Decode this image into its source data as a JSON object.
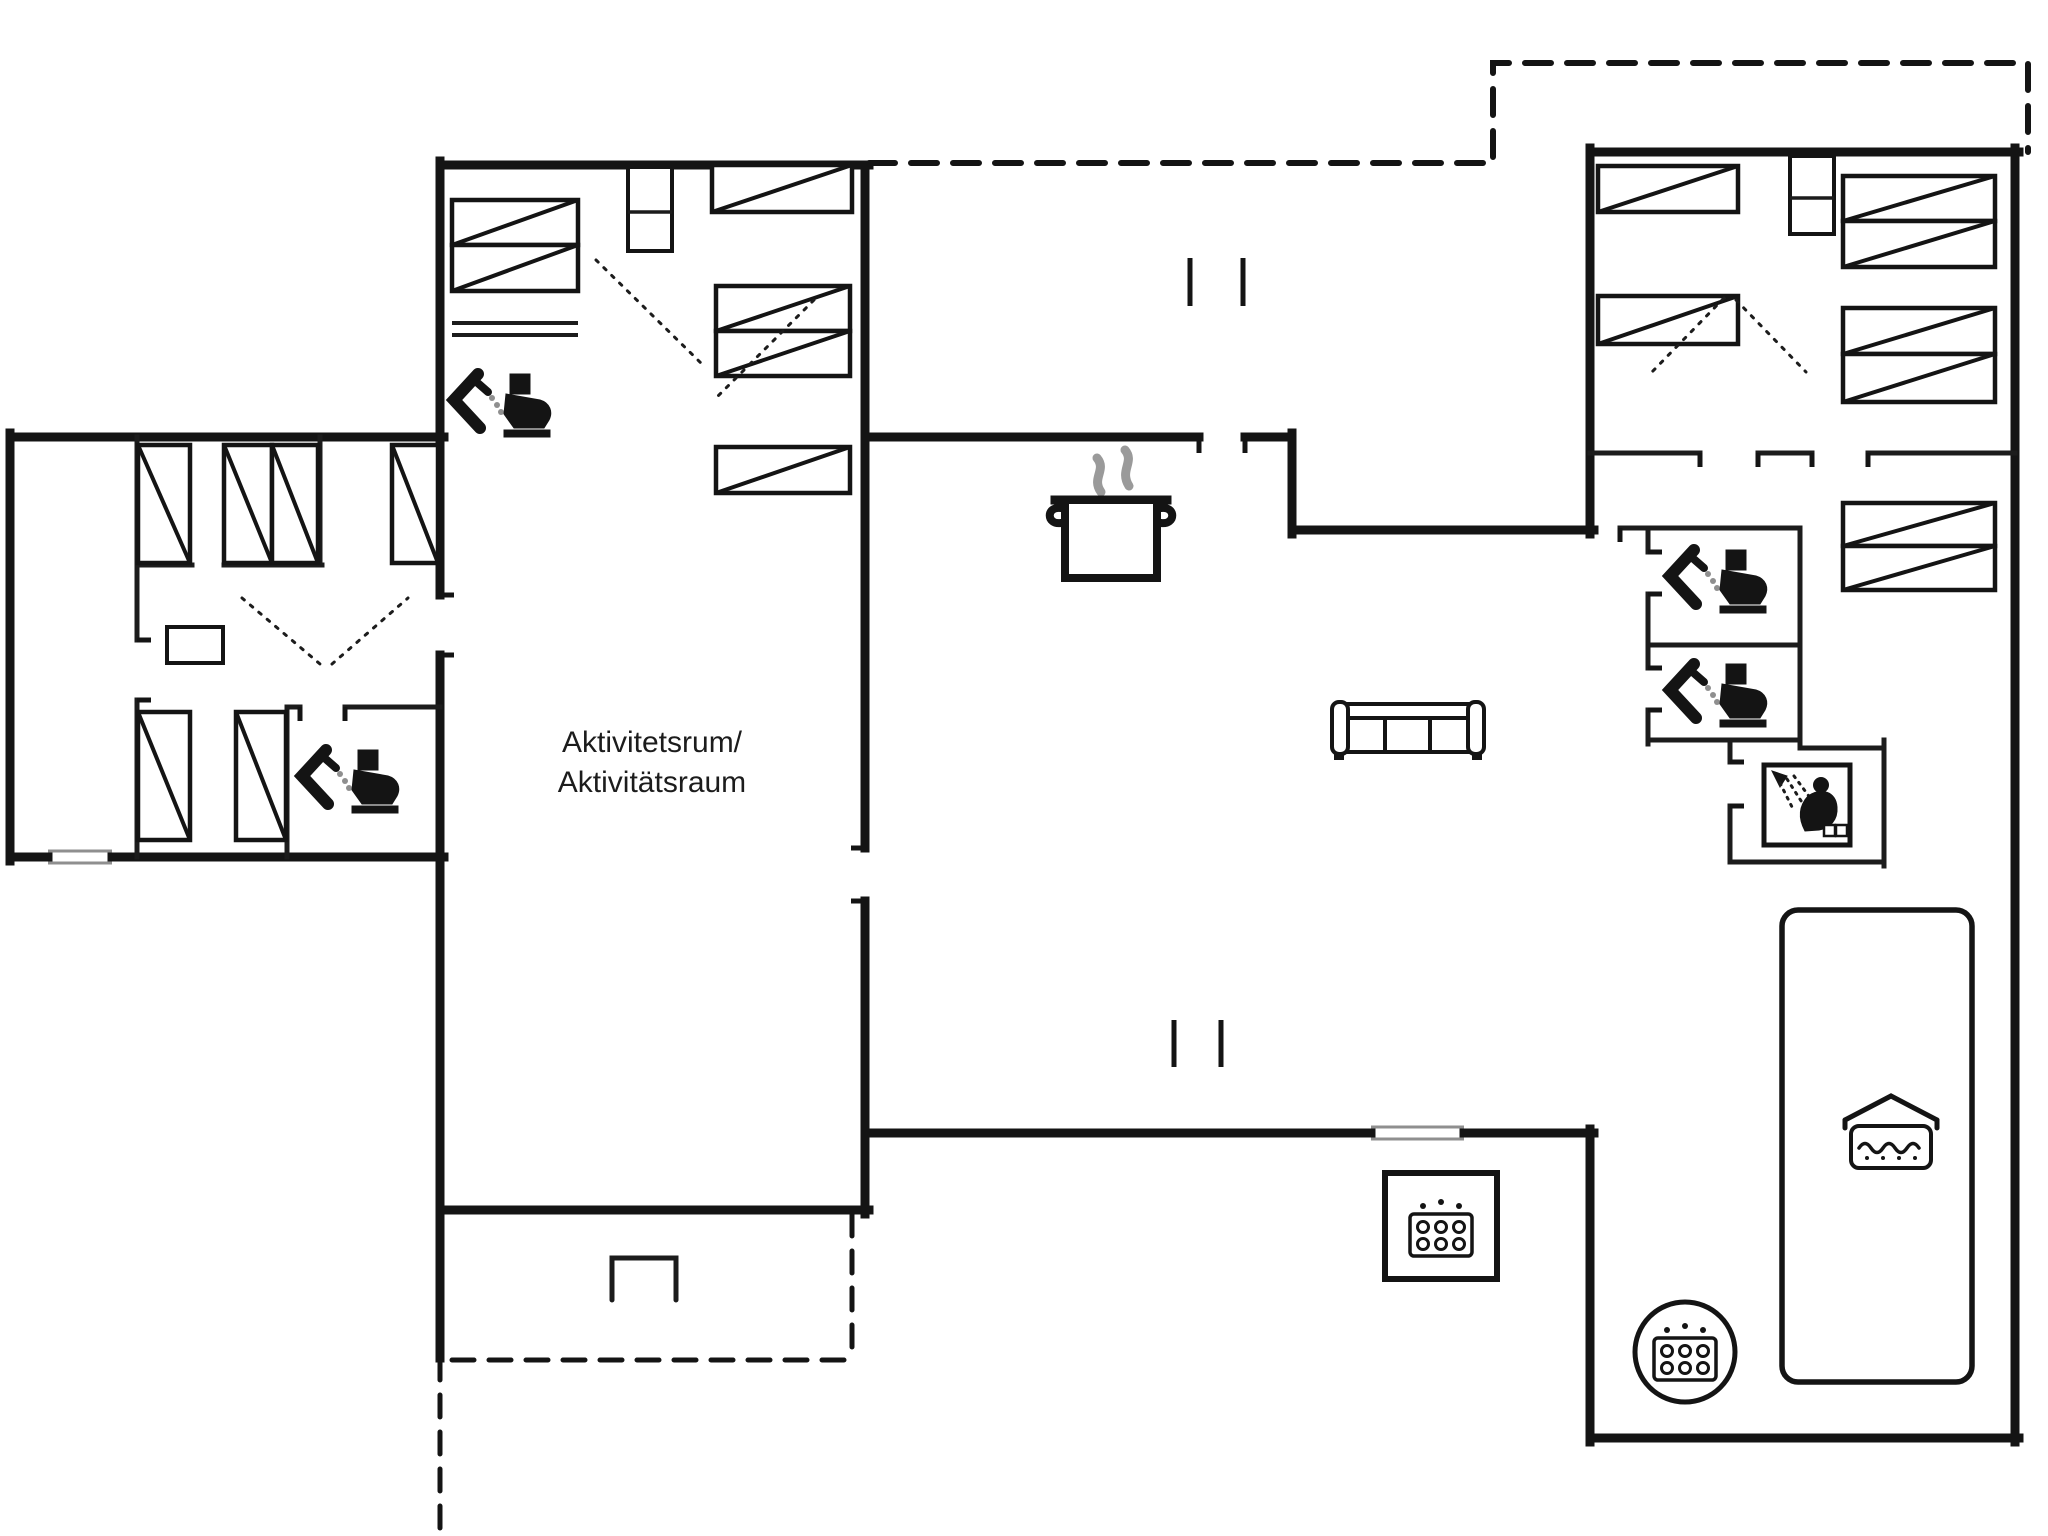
{
  "meta": {
    "background": "#ffffff",
    "wall_color": "#141414",
    "thin_color": "#1c1c1c",
    "gray": "#8f8f8f",
    "steam_gray": "#9a9a9a"
  },
  "label": {
    "line1": "Aktivitetsrum/",
    "line2": "Aktivitätsraum"
  },
  "walls_thick": [
    [
      10,
      437,
      444,
      437
    ],
    [
      10,
      433,
      10,
      861
    ],
    [
      10,
      857,
      48,
      857
    ],
    [
      112,
      857,
      444,
      857
    ],
    [
      440,
      165,
      869,
      165
    ],
    [
      440,
      161,
      440,
      595
    ],
    [
      440,
      655,
      440,
      1358
    ],
    [
      865,
      165,
      865,
      503
    ],
    [
      865,
      503,
      865,
      848
    ],
    [
      865,
      901,
      865,
      1214
    ],
    [
      865,
      437,
      1199,
      437
    ],
    [
      1245,
      437,
      1292,
      437
    ],
    [
      1292,
      433,
      1292,
      534
    ],
    [
      1292,
      530,
      1594,
      530
    ],
    [
      440,
      1210,
      869,
      1210
    ],
    [
      865,
      1133,
      1371,
      1133
    ],
    [
      1464,
      1133,
      1594,
      1133
    ],
    [
      1590,
      148,
      1590,
      534
    ],
    [
      1590,
      1129,
      1590,
      1442
    ],
    [
      1590,
      152,
      2019,
      152
    ],
    [
      2015,
      148,
      2015,
      1442
    ],
    [
      1590,
      1438,
      2019,
      1438
    ]
  ],
  "walls_thin": [
    [
      137,
      437,
      137,
      640
    ],
    [
      137,
      700,
      137,
      857
    ],
    [
      137,
      565,
      192,
      565
    ],
    [
      224,
      565,
      322,
      565
    ],
    [
      320,
      437,
      320,
      565
    ],
    [
      287,
      707,
      287,
      857
    ],
    [
      287,
      707,
      300,
      707
    ],
    [
      345,
      707,
      440,
      707
    ],
    [
      1620,
      528,
      1800,
      528
    ],
    [
      1648,
      528,
      1648,
      552
    ],
    [
      1648,
      594,
      1648,
      668
    ],
    [
      1648,
      710,
      1648,
      744
    ],
    [
      1648,
      645,
      1800,
      645
    ],
    [
      1648,
      740,
      1800,
      740
    ],
    [
      1800,
      528,
      1800,
      744
    ],
    [
      1590,
      453,
      1700,
      453
    ],
    [
      1758,
      453,
      1812,
      453
    ],
    [
      1868,
      453,
      2015,
      453
    ],
    [
      1884,
      740,
      1884,
      866
    ],
    [
      1730,
      862,
      1884,
      862
    ],
    [
      1730,
      740,
      1730,
      762
    ],
    [
      1730,
      806,
      1730,
      862
    ],
    [
      1800,
      748,
      1884,
      748
    ]
  ],
  "rects_thin": [
    [
      167,
      627,
      56,
      36
    ],
    [
      628,
      167,
      44,
      84
    ],
    [
      1790,
      156,
      44,
      78
    ]
  ],
  "extra_lines": [
    [
      628,
      212,
      672,
      212
    ],
    [
      1790,
      198,
      1834,
      198
    ]
  ],
  "dressers": [
    [
      452,
      323,
      578,
      323
    ],
    [
      452,
      335,
      578,
      335
    ]
  ],
  "beds": [
    [
      452,
      200,
      126,
      45
    ],
    [
      452,
      245,
      126,
      46
    ],
    [
      712,
      165,
      140,
      47
    ],
    [
      716,
      286,
      134,
      45
    ],
    [
      716,
      331,
      134,
      45
    ],
    [
      716,
      447,
      134,
      46
    ],
    [
      138,
      445,
      52,
      118
    ],
    [
      224,
      445,
      48,
      118
    ],
    [
      272,
      445,
      46,
      118
    ],
    [
      392,
      445,
      46,
      118
    ],
    [
      138,
      712,
      52,
      128
    ],
    [
      236,
      712,
      50,
      128
    ],
    [
      1598,
      166,
      140,
      46
    ],
    [
      1598,
      296,
      140,
      48
    ],
    [
      1843,
      176,
      152,
      45
    ],
    [
      1843,
      221,
      152,
      46
    ],
    [
      1843,
      308,
      152,
      46
    ],
    [
      1843,
      354,
      152,
      48
    ],
    [
      1843,
      503,
      152,
      43
    ],
    [
      1843,
      546,
      152,
      44
    ]
  ],
  "door_dotted": [
    [
      596,
      260,
      704,
      366
    ],
    [
      814,
      300,
      716,
      398
    ],
    [
      242,
      598,
      320,
      664
    ],
    [
      332,
      664,
      408,
      598
    ],
    [
      1724,
      298,
      1652,
      372
    ],
    [
      1736,
      300,
      1806,
      372
    ]
  ],
  "ticks": [
    [
      1199,
      437,
      1199,
      453
    ],
    [
      1245,
      437,
      1245,
      453
    ],
    [
      851,
      848,
      865,
      848
    ],
    [
      851,
      901,
      865,
      901
    ],
    [
      440,
      595,
      454,
      595
    ],
    [
      440,
      655,
      454,
      655
    ],
    [
      137,
      640,
      151,
      640
    ],
    [
      137,
      700,
      151,
      700
    ],
    [
      1700,
      453,
      1700,
      467
    ],
    [
      1758,
      453,
      1758,
      467
    ],
    [
      1812,
      453,
      1812,
      467
    ],
    [
      1868,
      453,
      1868,
      467
    ],
    [
      1648,
      552,
      1662,
      552
    ],
    [
      1648,
      594,
      1662,
      594
    ],
    [
      1648,
      668,
      1662,
      668
    ],
    [
      1648,
      710,
      1662,
      710
    ],
    [
      300,
      707,
      300,
      721
    ],
    [
      345,
      707,
      345,
      721
    ],
    [
      1620,
      528,
      1620,
      542
    ],
    [
      1730,
      762,
      1744,
      762
    ],
    [
      1730,
      806,
      1744,
      806
    ]
  ],
  "columns": [
    [
      1190,
      258,
      1190,
      306
    ],
    [
      1243,
      258,
      1243,
      306
    ],
    [
      1174,
      1020,
      1174,
      1067
    ],
    [
      1221,
      1020,
      1221,
      1067
    ]
  ],
  "windows": [
    [
      1371,
      1127,
      1464,
      1127
    ],
    [
      1371,
      1139,
      1464,
      1139
    ],
    [
      48,
      851,
      112,
      851
    ],
    [
      48,
      863,
      112,
      863
    ]
  ],
  "dashed_paths": [
    "M869,163 H1493 V63 H2028 V152",
    "M440,1358 V1536",
    "M452,1360 H852",
    "M852,1214 V1360"
  ],
  "grill_path": "M612,1300 L612,1258 L676,1258 L676,1300",
  "pool": {
    "x": 1782,
    "y": 910,
    "w": 190,
    "h": 472,
    "rx": 16
  },
  "icons": {
    "wc": [
      [
        452,
        372
      ],
      [
        300,
        748
      ],
      [
        1668,
        548
      ],
      [
        1668,
        662
      ]
    ],
    "shower": [
      1764,
      765
    ],
    "pot": [
      1055,
      452
    ],
    "sofa": [
      1340,
      700
    ],
    "pool_icon": [
      1845,
      1092
    ],
    "spa_square": {
      "rect": [
        1385,
        1173,
        112,
        106
      ],
      "icon": [
        1410,
        1202
      ]
    },
    "spa_round": {
      "cx": 1685,
      "cy": 1352,
      "r": 50,
      "icon": [
        1654,
        1326
      ]
    }
  }
}
